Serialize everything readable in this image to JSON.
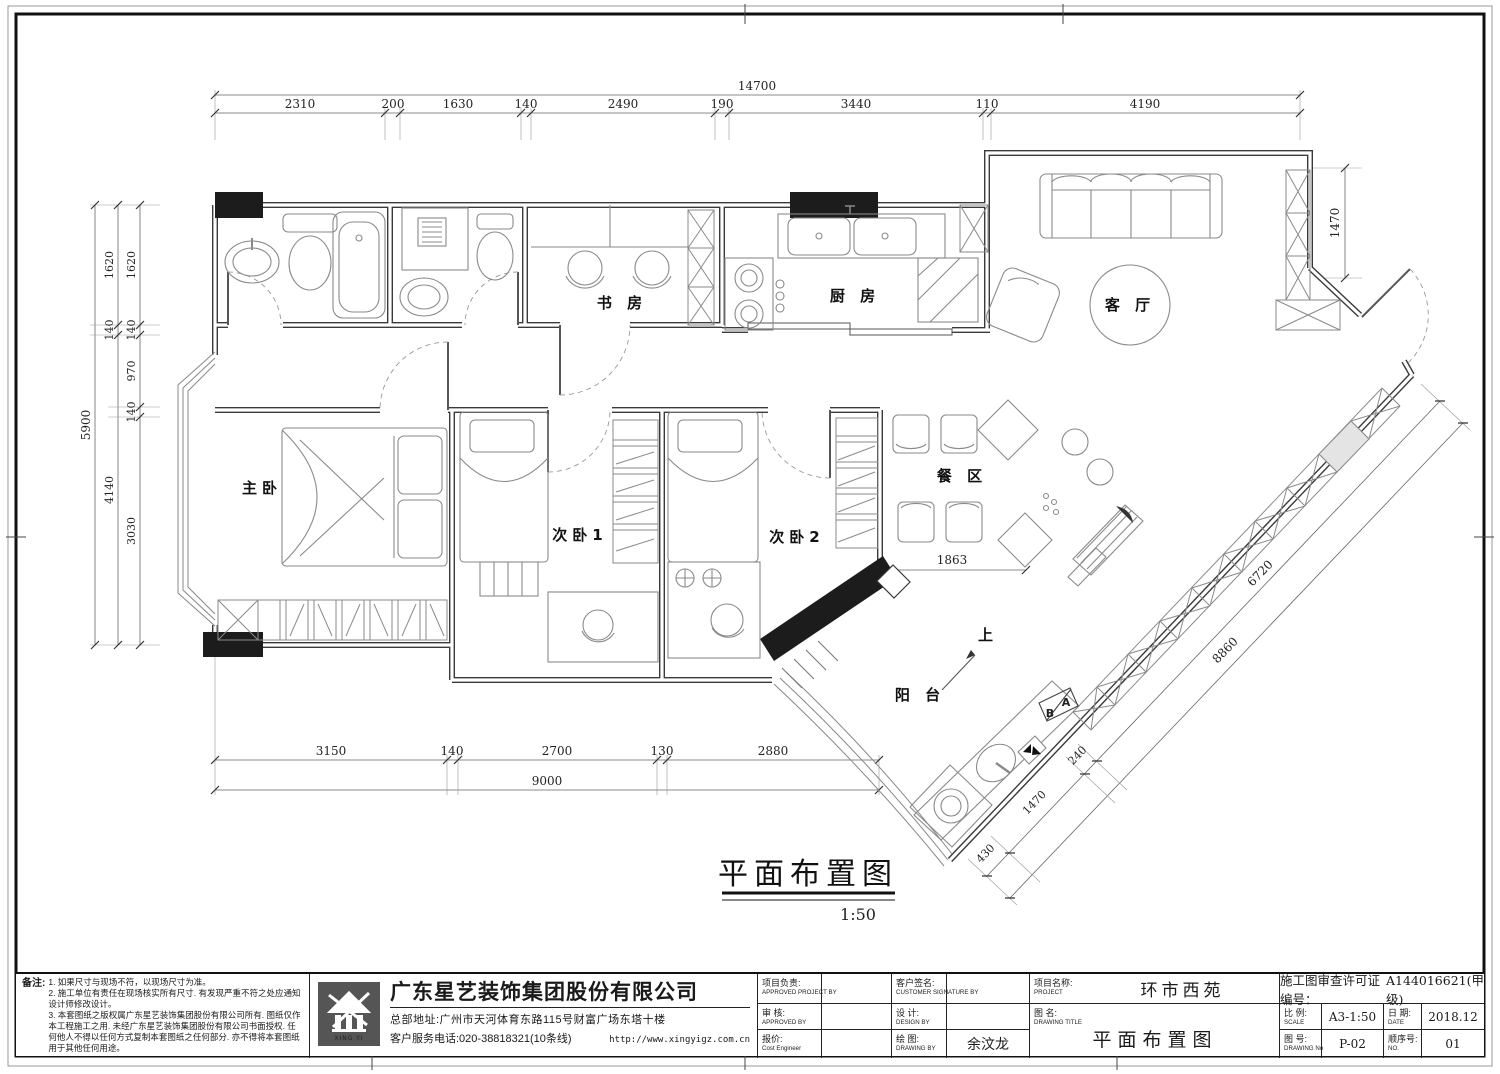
{
  "plan": {
    "rooms": {
      "master": "主卧",
      "bed2": "次卧1",
      "bed3": "次卧2",
      "study": "书 房",
      "kitchen": "厨 房",
      "living": "客 厅",
      "dining": "餐 区",
      "balcony": "阳 台"
    },
    "marks": {
      "up": "上",
      "a": "A",
      "b": "B"
    },
    "title": {
      "text": "平面布置图",
      "scale": "1:50"
    }
  },
  "dims": {
    "top": {
      "total": "14700",
      "segments": [
        "2310",
        "200",
        "1630",
        "140",
        "2490",
        "190",
        "3440",
        "110",
        "4190"
      ]
    },
    "left": {
      "total": "5900",
      "chain_mid": [
        "1620",
        "140",
        "4140"
      ],
      "chain_inner": [
        "1620",
        "140",
        "970",
        "140",
        "3030"
      ]
    },
    "bottom": {
      "total": "9000",
      "segments": [
        "3150",
        "140",
        "2700",
        "130",
        "2880"
      ]
    },
    "diag": {
      "total": "8860",
      "segments": [
        "6720",
        "240",
        "1470",
        "430"
      ]
    },
    "living_depth": "1470",
    "dining_width": "1863"
  },
  "titleblock": {
    "notes": {
      "label": "备注:",
      "items": [
        "1. 如果尺寸与现场不符，以现场尺寸为准。",
        "2. 施工单位有责任在现场核实所有尺寸. 有发现严重不符之处应通知设计师修改设计。",
        "3. 本套图纸之版权属广东星艺装饰集团股份有限公司所有. 图纸仅作本工程施工之用. 未经广东星艺装饰集团股份有限公司书面授权. 任何他人不得以任何方式复制本套图纸之任何部分. 亦不得将本套图纸用于其他任何用途。"
      ]
    },
    "company": {
      "logo_text": "XING YI",
      "name": "广东星艺装饰集团股份有限公司",
      "address": "总部地址:广州市天河体育东路115号财富广场东塔十楼",
      "phone": "客户服务电话:020-38818321(10条线)",
      "website": "http://www.xingyigz.com.cn"
    },
    "signatures": {
      "r1c1_cn": "项目负责:",
      "r1c1_en": "APPROVED PROJECT BY",
      "r1c2_cn": "客户签名:",
      "r1c2_en": "CUSTOMER SIGNATURE BY",
      "r2c1_cn": "审 核:",
      "r2c1_en": "APPROVED BY",
      "r2c2_cn": "设 计:",
      "r2c2_en": "DESIGN BY",
      "r3c1_cn": "报价:",
      "r3c1_en": "Cost Engineer",
      "r3c2_cn": "绘 图:",
      "r3c2_en": "DRAWING BY",
      "drawn_by": "余汶龙"
    },
    "project": {
      "label_cn": "项目名称:",
      "label_en": "PROJECT",
      "value": "环市西苑"
    },
    "drawing_title": {
      "label_cn": "图 名:",
      "label_en": "DRAWING TITLE",
      "value": "平面布置图"
    },
    "permit": {
      "label": "施工图审查许可证编号：",
      "value": "A144016621(甲级)"
    },
    "scale": {
      "label_cn": "比 例:",
      "label_en": "SCALE",
      "value": "A3-1:50"
    },
    "date": {
      "label_cn": "日 期:",
      "label_en": "DATE",
      "value": "2018.12"
    },
    "drawing_no": {
      "label_cn": "图 号:",
      "label_en": "DRAWING No",
      "value": "P-02"
    },
    "seq": {
      "label_cn": "顺序号:",
      "label_en": "NO.",
      "value": "01"
    }
  }
}
